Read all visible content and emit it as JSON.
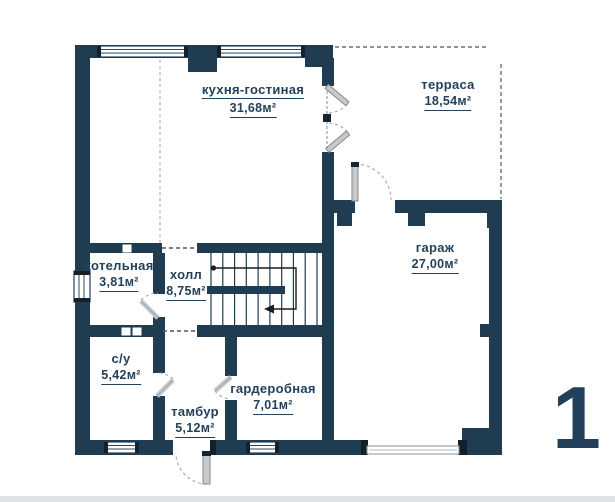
{
  "plan": {
    "number": "1",
    "area_unit": "м²"
  },
  "colors": {
    "wall": "#1f3c51",
    "text": "#23415a",
    "door_leaf": "#c6cacd",
    "window": "#ffffff",
    "dash": "#66717c"
  },
  "rooms": {
    "kitchen_living": {
      "name": "кухня-гостиная",
      "area": "31,68м²"
    },
    "terrace": {
      "name": "терраса",
      "area": "18,54м²"
    },
    "garage": {
      "name": "гараж",
      "area": "27,00м²"
    },
    "boiler": {
      "name": "котельная",
      "area": "3,81м²"
    },
    "hall": {
      "name": "холл",
      "area": "8,75м²"
    },
    "bathroom": {
      "name": "с/у",
      "area": "5,42м²"
    },
    "vestibule": {
      "name": "тамбур",
      "area": "5,12м²"
    },
    "wardrobe": {
      "name": "гардеробная",
      "area": "7,01м²"
    }
  }
}
